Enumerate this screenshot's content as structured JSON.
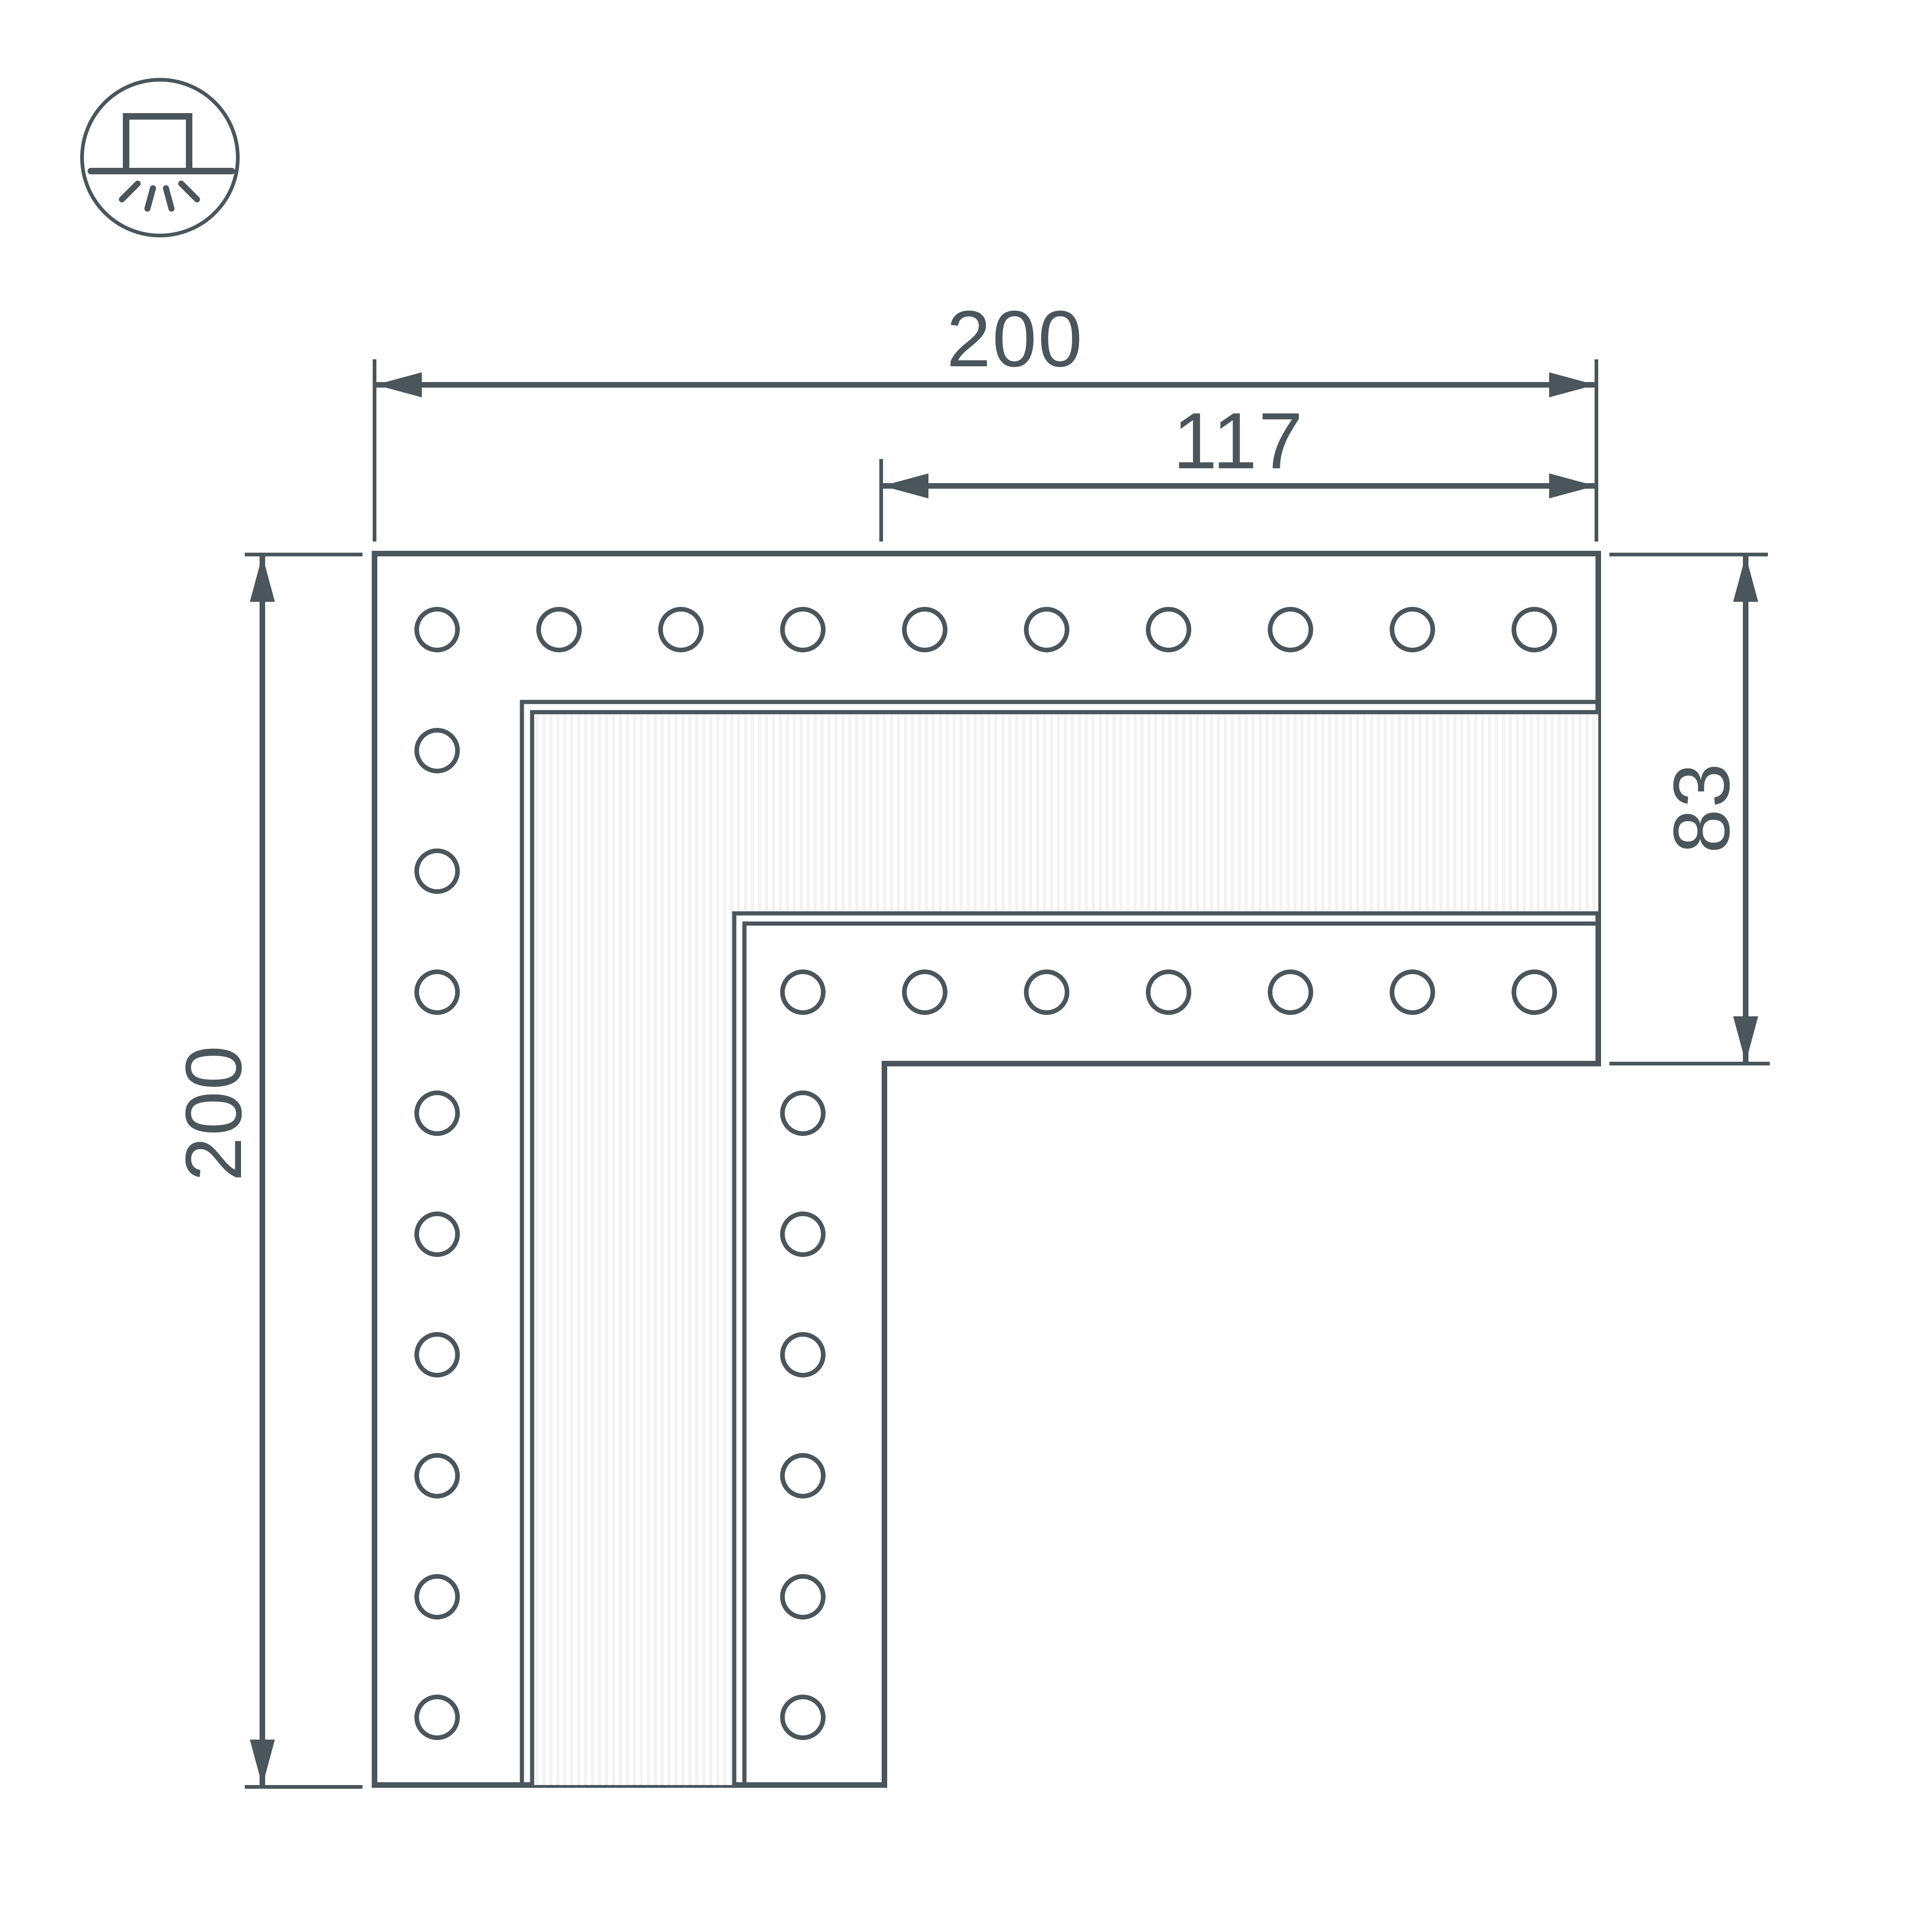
{
  "page": {
    "background": "#ffffff",
    "line_color": "#4b555c"
  },
  "legend_icon": {
    "name": "surface-mounted-light-icon"
  },
  "dimensions": {
    "top_width": "200",
    "inner_width": "117",
    "left_height": "200",
    "leg_width": "83"
  },
  "holes": {
    "shape": "circle",
    "rows": [
      {
        "name": "outer-top-row",
        "count": 10
      },
      {
        "name": "outer-left-column",
        "count": 10
      },
      {
        "name": "inner-top-row",
        "count": 7
      },
      {
        "name": "inner-left-column",
        "count": 7
      }
    ]
  }
}
